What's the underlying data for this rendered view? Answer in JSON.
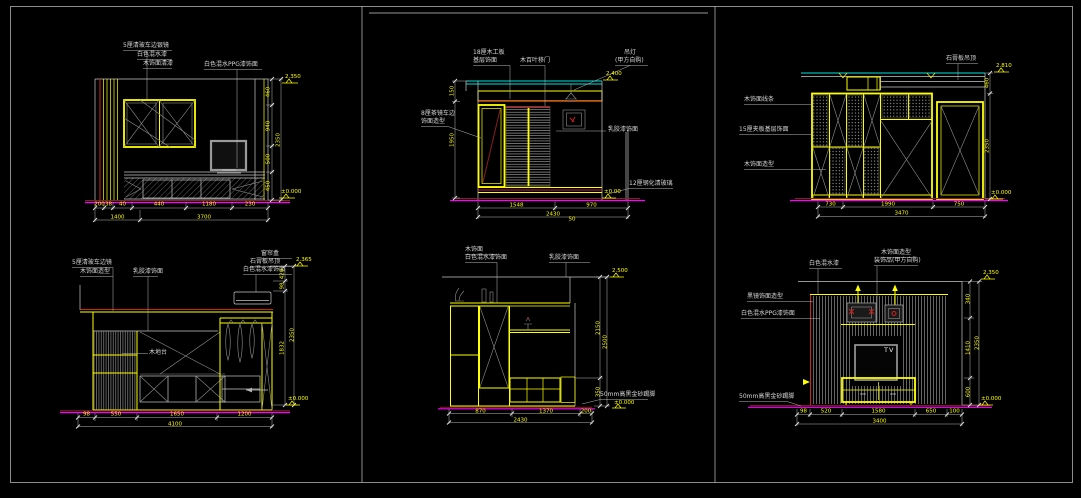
{
  "palette": {
    "background": "#000000",
    "linework_white": "#c8c8c8",
    "linework_yellow": "#ffff00",
    "linework_red": "#d02020",
    "floor_magenta": "#ff00ff",
    "ceiling_cyan": "#00e0e0",
    "hatch_gray": "#909090"
  },
  "drawings": {
    "a": {
      "annotations": [
        "5厘清玻车边银镜",
        "白色混水漆",
        "木饰面清漆",
        "白色混水PPG漆饰面"
      ],
      "dims_bottom": [
        "200",
        "38",
        "40",
        "440",
        "1180",
        "230"
      ],
      "dims_bottom_row2": [
        "1400",
        "3700"
      ],
      "dims_right": [
        "460",
        "940",
        "500",
        "450"
      ],
      "dims_right_total": "2350",
      "level_top": "2.350",
      "level_bottom": "±0.000"
    },
    "b": {
      "annotations": {
        "mirror1": "8厘茶镜车边",
        "mirror2": "饰面造型",
        "board1": "18厘木工板",
        "board2": "基层饰面",
        "door": "木百叶移门",
        "lamp1": "吊灯",
        "lamp2": "(甲方自购)",
        "paint": "乳胶漆饰面",
        "glass": "12厘钢化清玻璃"
      },
      "dims_left": [
        "150",
        "1950"
      ],
      "dims_bottom": [
        "1548",
        "970"
      ],
      "dims_bottom_extra": "50",
      "dims_bottom_total": "2430",
      "level_top": "2.400",
      "level_bottom": "±0.00"
    },
    "c": {
      "annotations": [
        "木饰面线条",
        "15厘夹板基层饰面",
        "木饰面造型",
        "石膏板吊顶"
      ],
      "dims_bottom": [
        "730",
        "1990",
        "750"
      ],
      "dims_bottom_total": "3470",
      "dims_right": [
        "460",
        "2350"
      ],
      "level_top": "2.810",
      "level_bottom": "±0.000"
    },
    "d": {
      "annotations": {
        "mirror": "5厘清玻车边镜",
        "wood": "木饰面造型",
        "paint": "乳胶漆饰面",
        "platform": "木地台",
        "curtain": "窗帘盒",
        "ceiling": "石膏板吊顶",
        "white": "白色混水漆饰面"
      },
      "dims_bottom": [
        "98",
        "550",
        "1650",
        "1200"
      ],
      "dims_bottom_total": "4100",
      "dims_right": [
        "420",
        "98",
        "1832"
      ],
      "dims_right_total": "2350",
      "level_top": "2.365",
      "level_bottom": "±0.000"
    },
    "e": {
      "annotations": {
        "wood": "木饰面",
        "white": "白色混水漆饰面",
        "paint": "乳胶漆饰面",
        "skirting": "50mm高黑金砂踢脚"
      },
      "dims_bottom": [
        "870",
        "1370",
        "200"
      ],
      "dims_bottom_total": "2430",
      "dims_right": [
        "2150",
        "350"
      ],
      "dims_right_total": "2500",
      "level_top": "2.500",
      "level_bottom": "±0.000"
    },
    "f": {
      "annotations": {
        "white": "白色混水漆",
        "wood": "木饰面造型",
        "decor": "装饰品(甲方自购)",
        "mirror": "黑镜饰面造型",
        "ppg": "白色混水PPG漆饰面",
        "skirting": "50mm高黑金砂踢脚"
      },
      "tv_label": "TV",
      "dims_bottom": [
        "98",
        "520",
        "1580",
        "650",
        "100"
      ],
      "dims_bottom_total": "3400",
      "dims_right": [
        "340",
        "1410",
        "600"
      ],
      "dims_right_total": "2350",
      "level_top": "2.350",
      "level_bottom": "±0.000"
    }
  }
}
